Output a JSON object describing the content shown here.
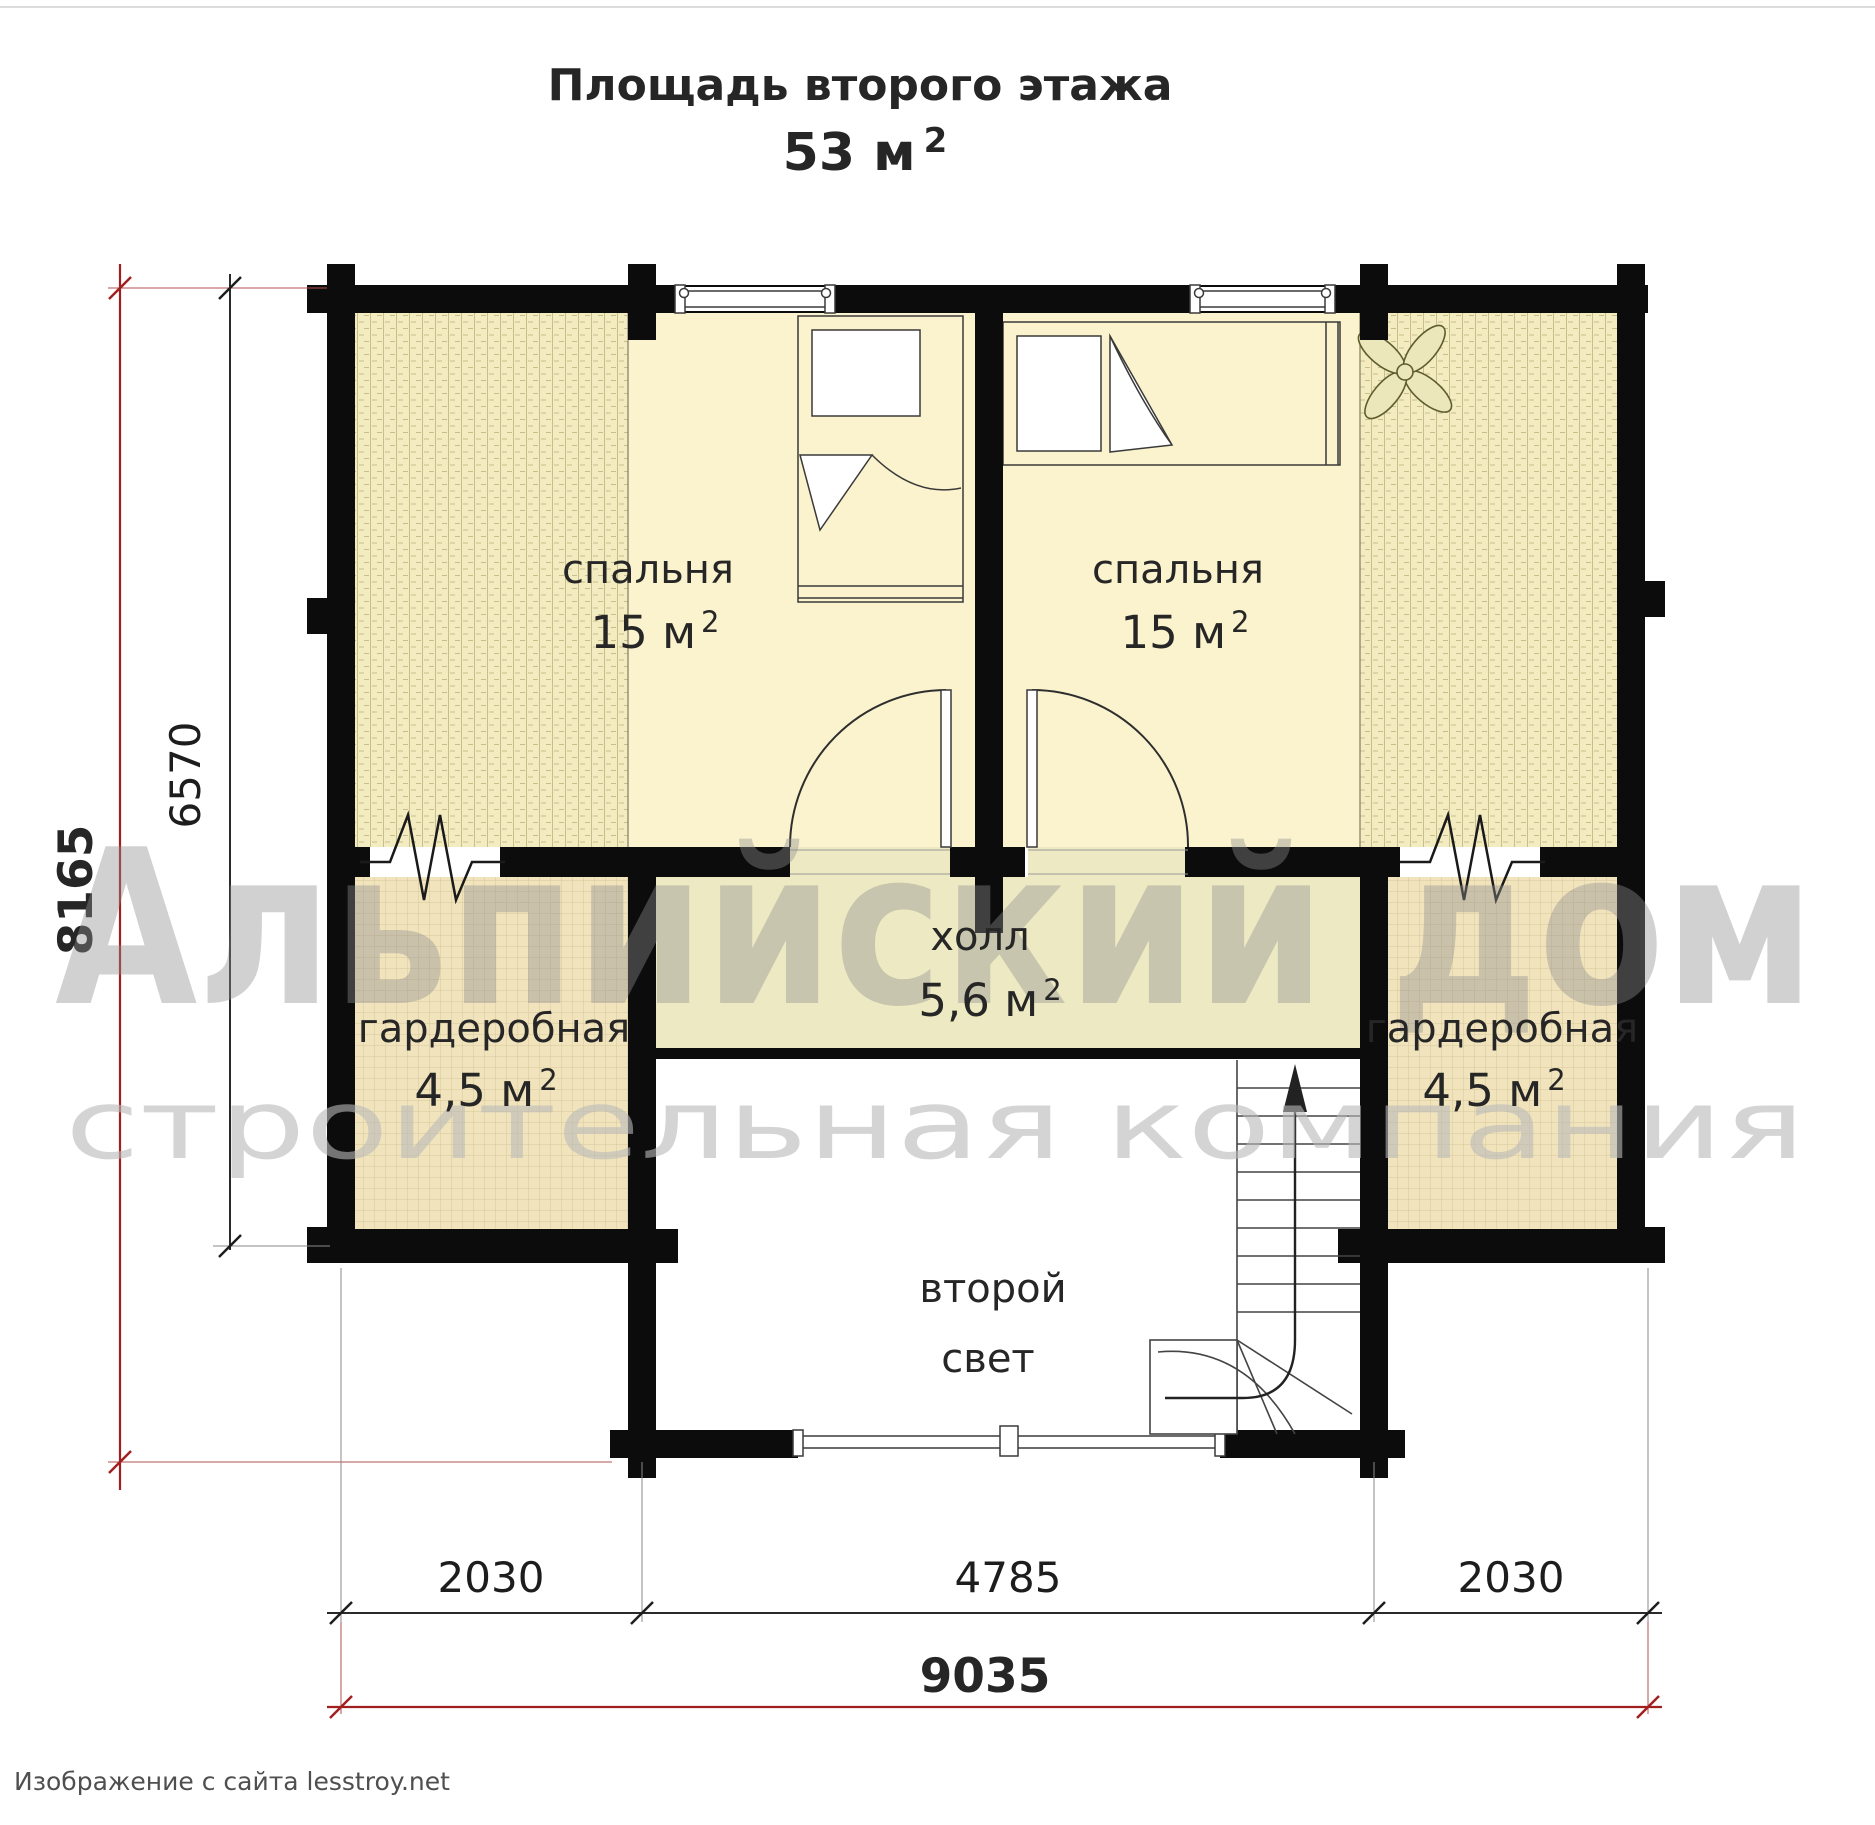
{
  "title": {
    "text": "Площадь второго этажа",
    "area": "53 м",
    "area_sup": "2"
  },
  "watermark": {
    "line1": "Альпийский дом",
    "line2": "строительная компания"
  },
  "rooms": {
    "bedroom_left": {
      "name": "спальня",
      "area": "15 м",
      "area_sup": "2"
    },
    "bedroom_right": {
      "name": "спальня",
      "area": "15 м",
      "area_sup": "2"
    },
    "hall": {
      "name": "холл",
      "area": "5,6 м",
      "area_sup": "2"
    },
    "wardrobe_left": {
      "name": "гардеробная",
      "area": "4,5 м",
      "area_sup": "2"
    },
    "wardrobe_right": {
      "name": "гардеробная",
      "area": "4,5 м",
      "area_sup": "2"
    },
    "second_light": {
      "line1": "второй",
      "line2": "свет"
    }
  },
  "dimensions": {
    "left_inner": "6570",
    "left_total": "8165",
    "bottom_left": "2030",
    "bottom_middle": "4785",
    "bottom_right": "2030",
    "bottom_total": "9035"
  },
  "footer": {
    "credit": "Изображение с сайта lesstroy.net"
  },
  "colors": {
    "wall": "#0c0c0c",
    "bedroom_floor": "#faf3cd",
    "hatch_floor": "#f3ecc0",
    "wardrobe_floor": "#f1e4bd",
    "hall_floor": "#edeac3",
    "dimension_red": "#a11f1f",
    "watermark_gray": "#8f8f8f"
  }
}
